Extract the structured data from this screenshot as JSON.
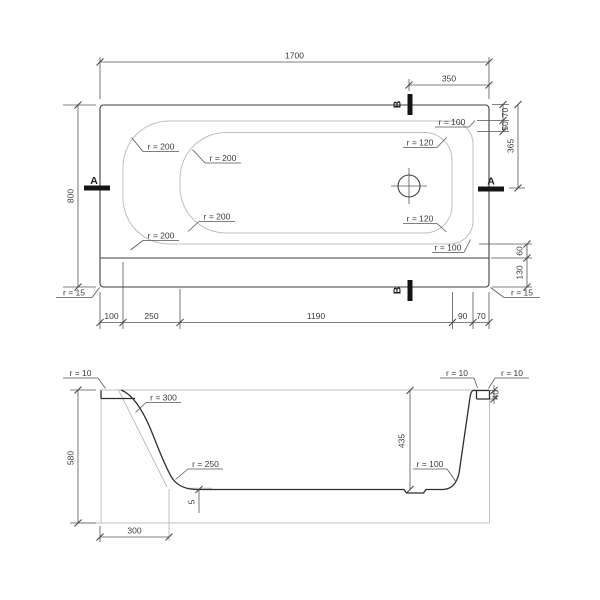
{
  "drawing": {
    "plan": {
      "dims": {
        "overall_length": "1700",
        "b_offset": "350",
        "overall_width": "800",
        "rim_top": "70",
        "floor_top": "50",
        "drain_from_top": "365",
        "rim_bottom": "60",
        "deck_bottom": "130",
        "chain": [
          "100",
          "250",
          "1190",
          "90",
          "70"
        ]
      },
      "radii": {
        "rim_top_left": "r = 200",
        "floor_top_left": "r = 200",
        "floor_bottom_left": "r = 200",
        "rim_bottom_left": "r = 200",
        "rim_top_right": "r = 100",
        "floor_top_right": "r = 120",
        "floor_bottom_right": "r = 120",
        "rim_bottom_right": "r = 100",
        "corner_bottom_left": "r = 15",
        "corner_bottom_right": "r = 15"
      },
      "section_markers": {
        "a": "A",
        "b": "B"
      }
    },
    "section": {
      "dims": {
        "total_height": "580",
        "inner_depth": "435",
        "left_slope_width": "300",
        "rim_thickness": "40",
        "bottom_slope": "5"
      },
      "radii": {
        "rim_left": "r = 10",
        "wall_left": "r = 300",
        "floor_left": "r = 250",
        "floor_right": "r = 100",
        "rim_right_inner": "r = 10",
        "rim_right_outer": "r = 10"
      }
    }
  }
}
